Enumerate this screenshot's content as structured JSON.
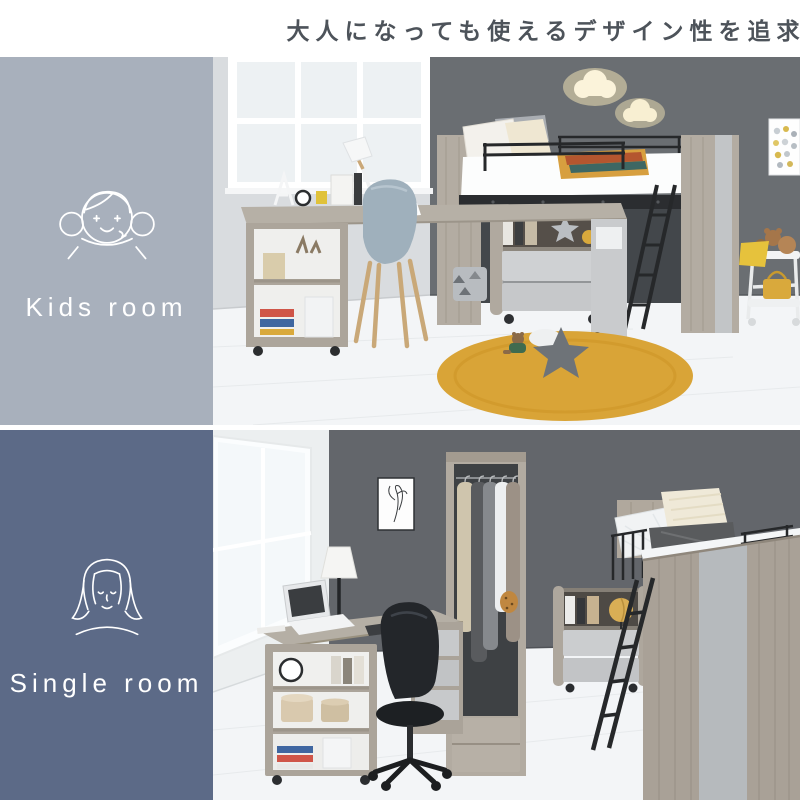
{
  "header": {
    "title": "大人になっても使えるデザイン性を追求"
  },
  "panels": {
    "kids": {
      "label": "Kids room",
      "icon": "girl-face-icon",
      "sidebar_color": "#a8b0bc"
    },
    "single": {
      "label": "Single room",
      "icon": "woman-face-icon",
      "sidebar_color": "#5c6a87"
    }
  },
  "colors": {
    "title_text": "#4d535a",
    "label_text": "#ffffff",
    "kids_sidebar": "#a8b0bc",
    "single_sidebar": "#5c6a87",
    "accent_rug": "#d9a437",
    "dark_wall": "#65696e",
    "wood": "#b2aba1",
    "background": "#ffffff"
  }
}
